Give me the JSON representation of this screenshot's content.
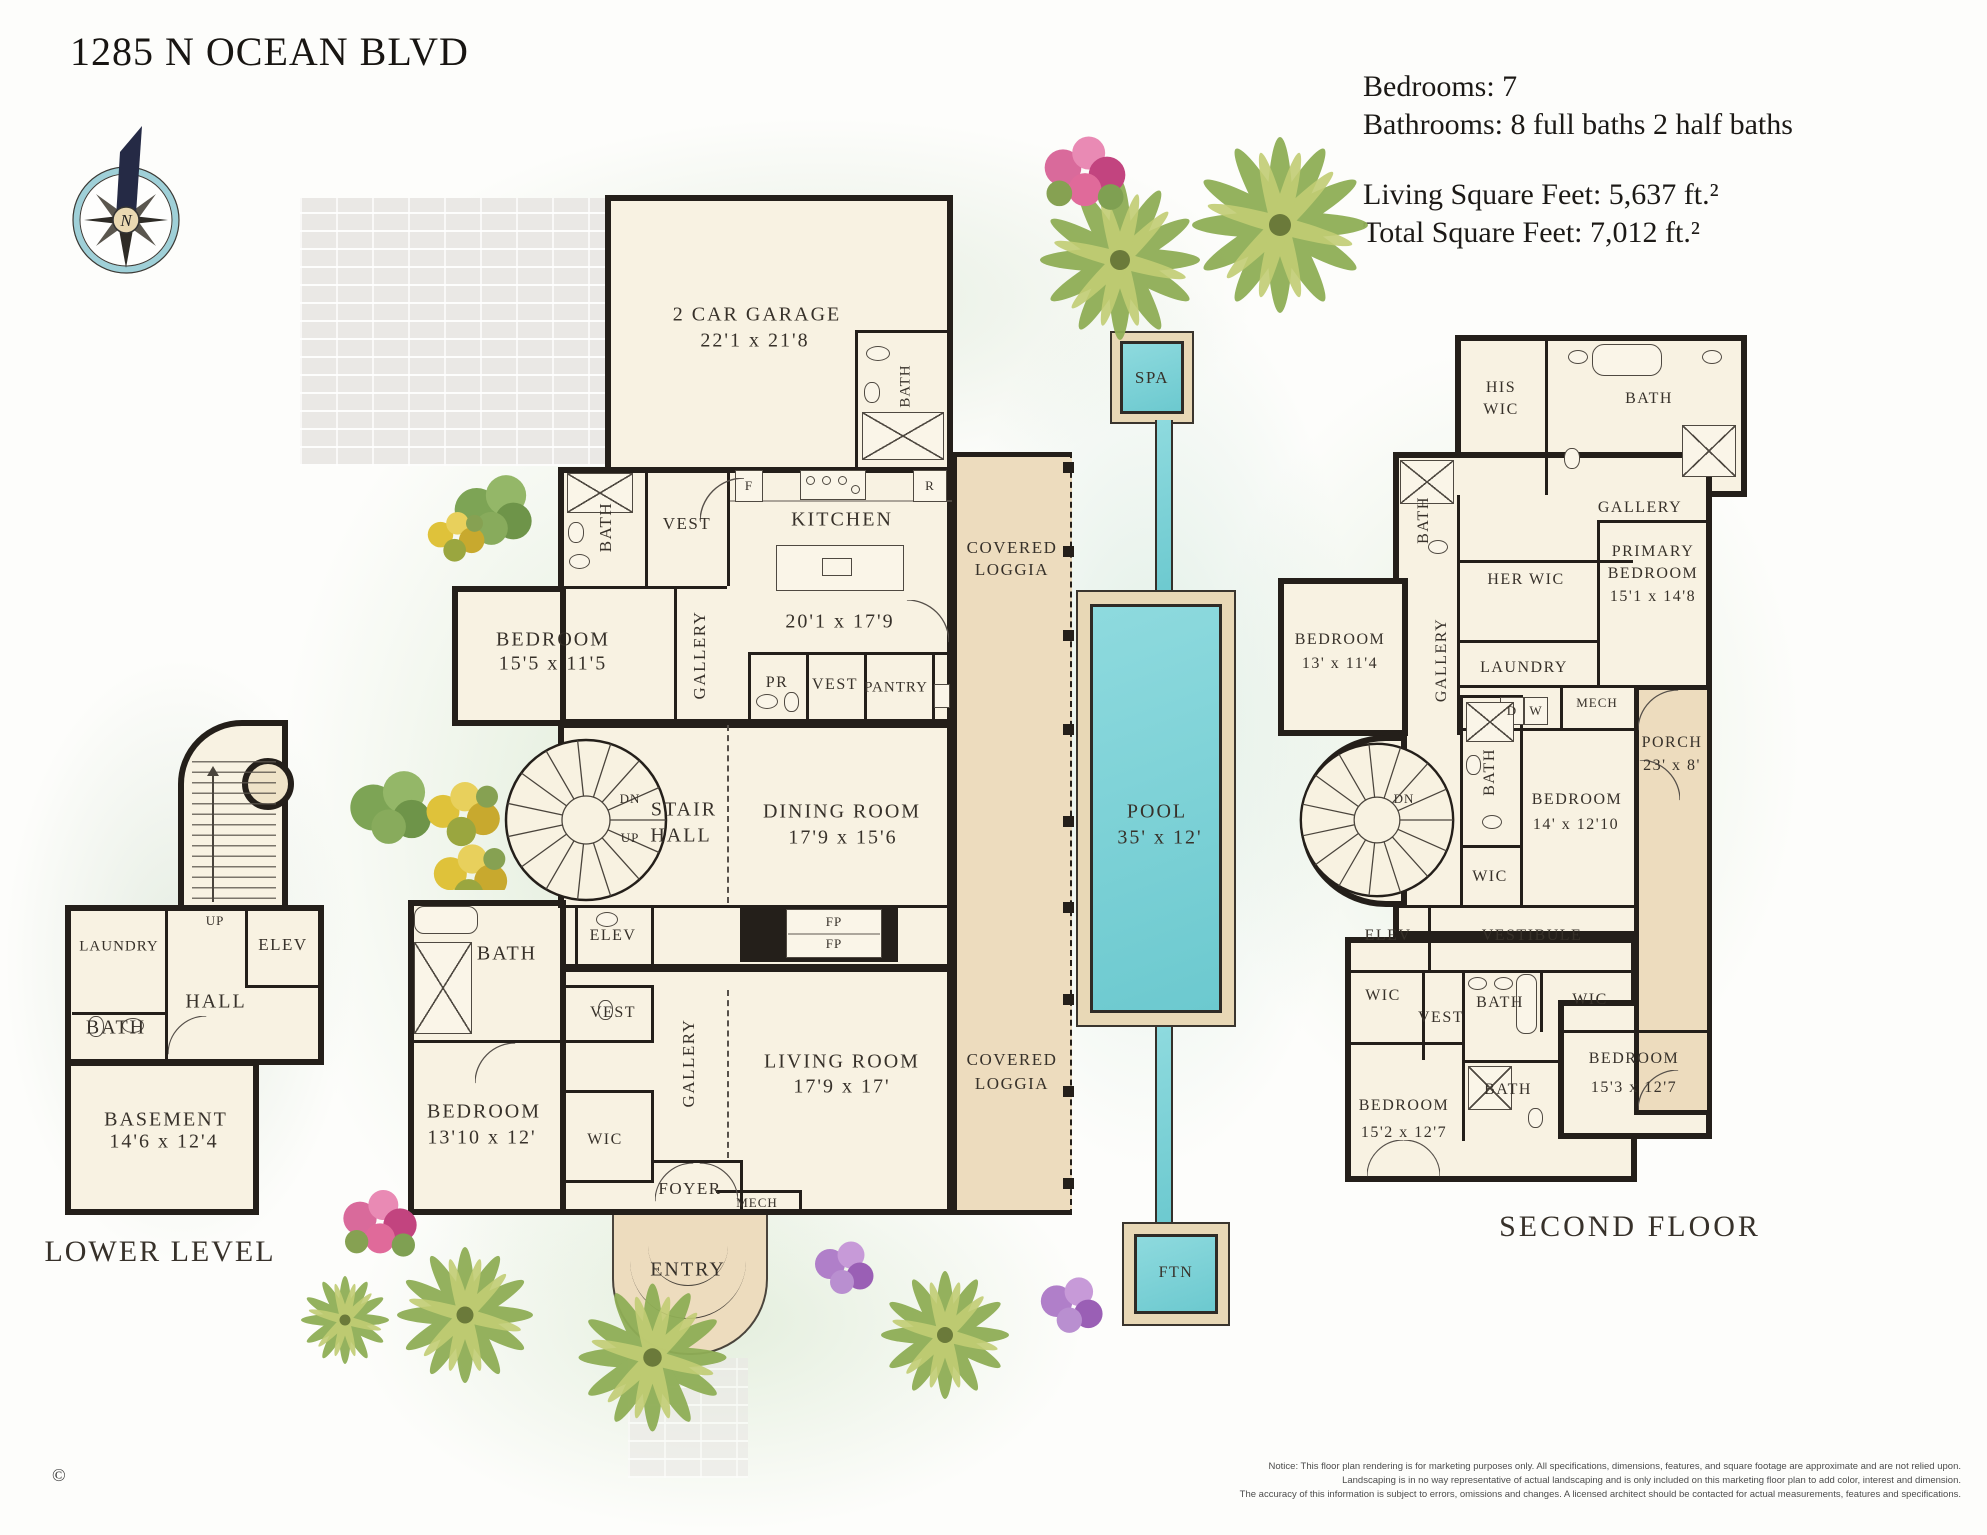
{
  "title": "1285 N OCEAN BLVD",
  "compass": {
    "north": "N"
  },
  "stats": {
    "bedrooms": "Bedrooms: 7",
    "bathrooms": "Bathrooms: 8 full baths 2 half baths",
    "living": "Living Square Feet: 5,637 ft.²",
    "total": "Total Square Feet:  7,012 ft.²"
  },
  "g": {
    "bath": "BATH",
    "vest": "VEST",
    "wic": "WIC",
    "elev": "ELEV",
    "gallery": "GALLERY",
    "hall": "HALL",
    "laundry": "LAUNDRY",
    "mech": "MECH",
    "pantry": "PANTRY",
    "pr": "PR",
    "foyer": "FOYER",
    "entry": "ENTRY",
    "dn": "DN",
    "up": "UP",
    "f": "F",
    "r": "R",
    "d": "D",
    "w": "W",
    "fp": "FP",
    "covered": "COVERED",
    "loggia": "LOGGIA",
    "stair": "STAIR",
    "vestibule": "VESTIBULE",
    "porch": "PORCH",
    "bedroom": "BEDROOM",
    "n": "N"
  },
  "main": {
    "garage_name": "2 CAR GARAGE",
    "garage_dims": "22'1 x 21'8",
    "kitchen": "KITCHEN",
    "kitchen_dims": "20'1 x 17'9",
    "bedroom_ne_dims": "15'5 x 11'5",
    "dining": "DINING ROOM",
    "dining_dims": "17'9 x 15'6",
    "living": "LIVING ROOM",
    "living_dims": "17'9 x 17'",
    "bedroom_sw_dims": "13'10 x 12'"
  },
  "second": {
    "label": "SECOND FLOOR",
    "his": "HIS",
    "her_wic": "HER WIC",
    "primary1": "PRIMARY",
    "primary2": "BEDROOM",
    "primary_dims": "15'1 x 14'8",
    "bedroom_nw_dims": "13' x 11'4",
    "bedroom_mid_dims": "14' x 12'10",
    "bedroom_se_dims": "15'3 x 12'7",
    "bedroom_sw_d": "15'2 x 12'7",
    "porch_dims": "23' x 8'"
  },
  "lower": {
    "label": "LOWER LEVEL",
    "basement": "BASEMENT",
    "basement_dims": "14'6 x 12'4"
  },
  "pool": {
    "spa": "SPA",
    "pool": "POOL",
    "dims": "35' x 12'",
    "ftn": "FTN"
  },
  "notice": {
    "l1": "Notice:  This floor plan rendering is for marketing purposes only. All specifications, dimensions, features, and square footage are approximate and are not relied upon.",
    "l2": "Landscaping is in no way representative of actual landscaping and is only included on this marketing floor plan to add color, interest and dimension.",
    "l3": "The accuracy of this information is subject to errors, omissions and changes. A licensed architect should be contacted for actual measurements, features and specifications."
  },
  "copyright": "©",
  "colors": {
    "wall": "#241f1a",
    "room": "#f8f2e2",
    "outdoor": "#eddcbe",
    "water": "#7fd3d6",
    "compass_ring": "#9fd0d8"
  }
}
